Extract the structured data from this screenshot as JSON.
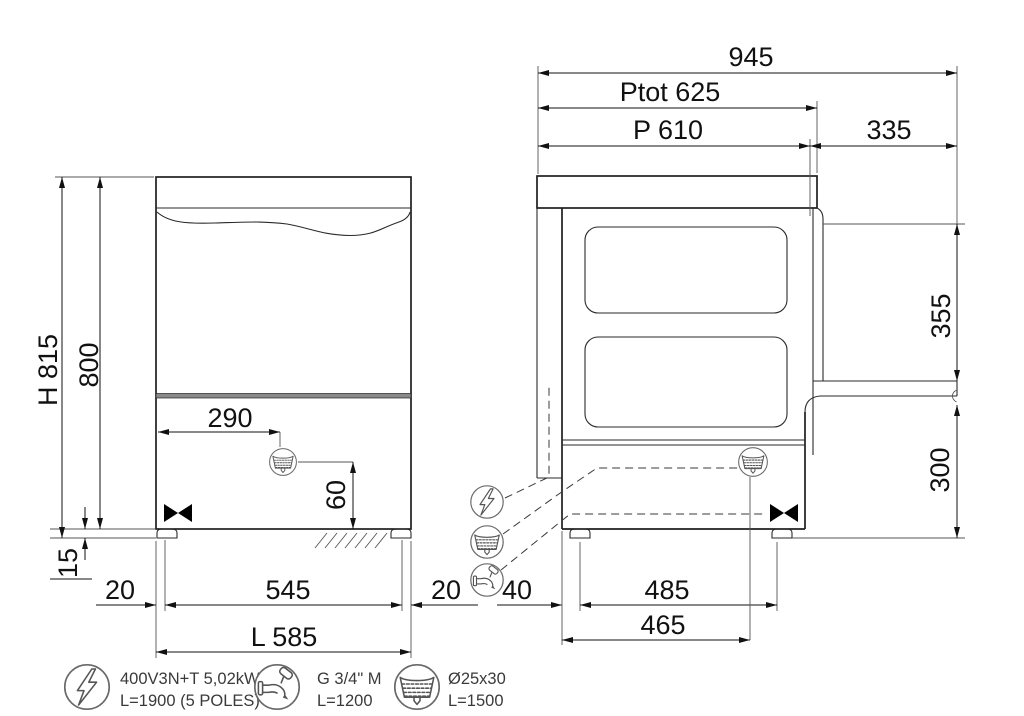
{
  "drawing": {
    "type": "technical-dimension-drawing",
    "subject": "undercounter dishwasher front and side views",
    "colors": {
      "background": "#ffffff",
      "line": "#1f1f1f",
      "dim_text": "#111111",
      "icon_stroke": "#6a6a6a"
    },
    "front_view": {
      "dims": {
        "h_total": "H 815",
        "h_body": "800",
        "foot_h": "15",
        "drain_x": "290",
        "drain_h": "60",
        "inset_l": "20",
        "foot_span": "545",
        "inset_r": "20",
        "w_total": "L 585"
      }
    },
    "side_view": {
      "dims": {
        "total_depth_open": "945",
        "depth_panel": "Ptot 625",
        "depth_body": "P 610",
        "door_depth": "335",
        "opening_height": "355",
        "door_floor": "300",
        "back_gap": "40",
        "foot_span": "485",
        "drain_pos": "465"
      },
      "connection_icons": [
        "electric-icon",
        "drain-icon",
        "water-tap-icon"
      ]
    },
    "legend": {
      "items": [
        {
          "name": "electrical-connection",
          "icon": "electric-icon",
          "line1": "400V3N+T 5,02kW",
          "line2": "L=1900 (5 POLES)"
        },
        {
          "name": "water-inlet",
          "icon": "water-tap-icon",
          "line1": "G 3/4\" M",
          "line2": "L=1200"
        },
        {
          "name": "drain-outlet",
          "icon": "drain-icon",
          "line1": "Ø25x30",
          "line2": "L=1500"
        }
      ]
    }
  }
}
